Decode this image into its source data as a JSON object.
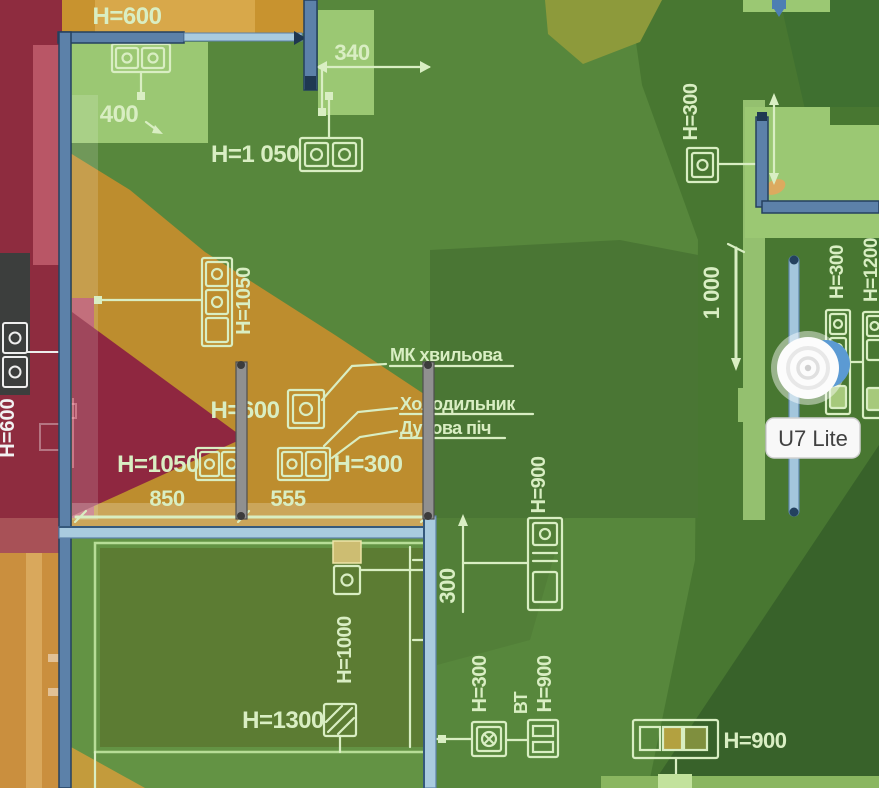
{
  "device": {
    "label": "U7 Lite",
    "type": "access-point"
  },
  "appliances": {
    "microwave": "МК хвильова",
    "fridge": "Холодильник",
    "oven": "Духова піч"
  },
  "heights": {
    "top_h600": "Н=600",
    "top_h1050": "Н=1 050",
    "stack_h1050": "Н=1050",
    "kitchen_h600": "Н=600",
    "kitchen_h1050": "Н=1050",
    "kitchen_h300": "Н=300",
    "center_h900": "Н=900",
    "right_h300": "Н=300",
    "edge_h300": "Н=300",
    "edge_h1200": "Н=1200",
    "room_h1000": "Н=1000",
    "room_h1300": "Н=1300",
    "bottom_h300": "Н=300",
    "bottom_bt": "ВТ",
    "bottom_h900": "Н=900",
    "outlet_h900": "Н=900",
    "left_h600": "Н=600"
  },
  "dimensions": {
    "d340": "340",
    "d400": "400",
    "d850": "850",
    "d555": "555",
    "d300": "300",
    "d1000": "1 000"
  },
  "colors": {
    "heat_red": "#8e2c3f",
    "heat_pink": "#b95666",
    "heat_amber": "#c8932f",
    "heat_orange": "#ca8f3e",
    "heat_olive": "#8d9a3b",
    "heat_green_mid": "#57873c",
    "heat_green_dark": "#44732e",
    "heat_green_pale": "#9bc873",
    "wall_blue": "#5c81a9",
    "wall_light": "#a9cbdf",
    "partition_gray": "#909090",
    "plan_line": "#d9eec3",
    "device_accent": "#5b9ad3",
    "device_label_bg": "#f8f8f8"
  }
}
